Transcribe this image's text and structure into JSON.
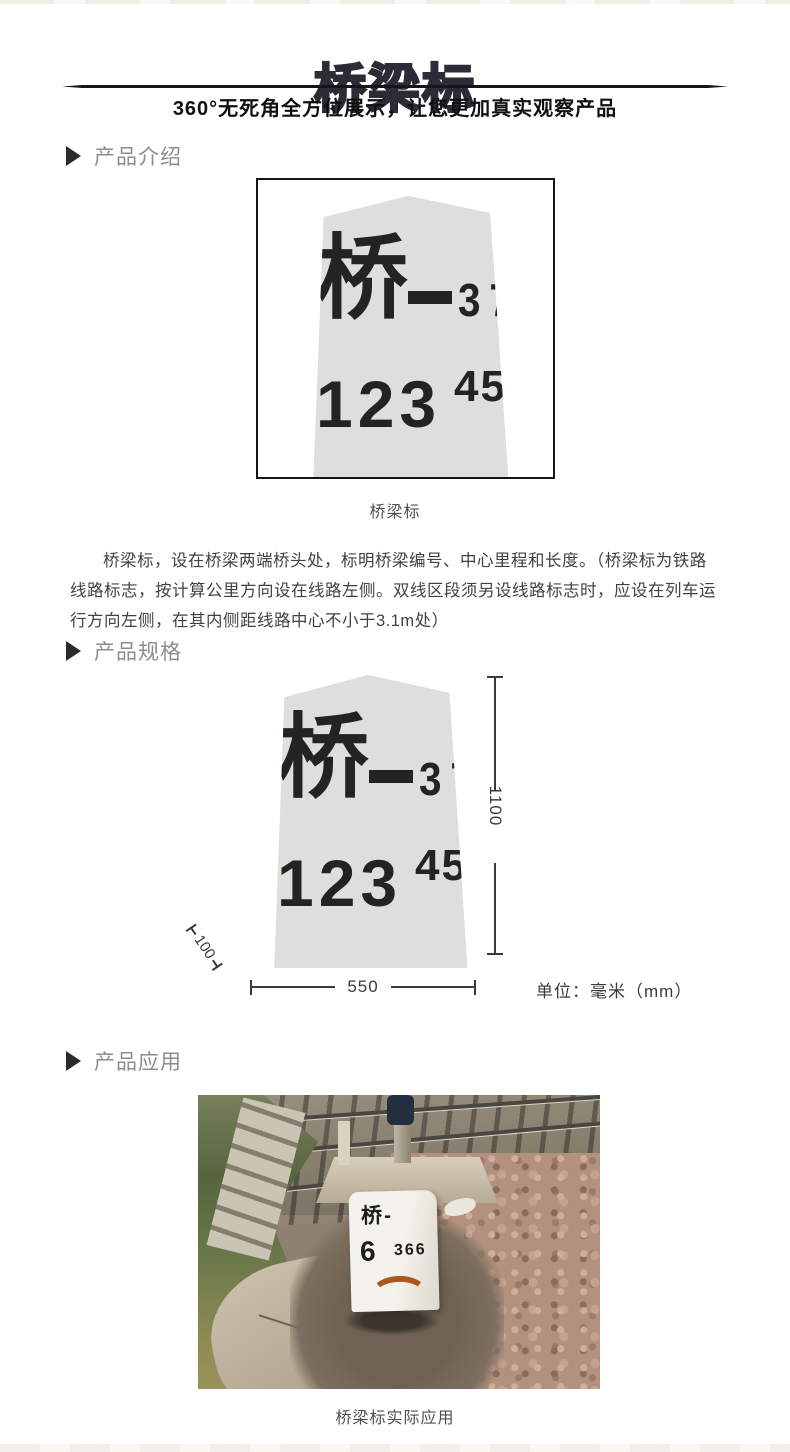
{
  "header": {
    "title": "桥梁标",
    "subtitle": "360°无死角全方位展示，让您更加真实观察产品"
  },
  "sections": {
    "intro_label": "产品介绍",
    "spec_label": "产品规格",
    "app_label": "产品应用"
  },
  "marker_face": {
    "char": "桥",
    "dash": "-",
    "serial": "37",
    "mileage_main": "123",
    "mileage_sup": "456"
  },
  "intro": {
    "caption": "桥梁标",
    "description": "桥梁标，设在桥梁两端桥头处，标明桥梁编号、中心里程和长度。（桥梁标为铁路线路标志，按计算公里方向设在线路左侧。双线区段须另设线路标志时，应设在列车运行方向左侧，在其内侧距线路中心不小于3.1m处）"
  },
  "spec": {
    "height_mm": "1100",
    "width_mm": "550",
    "base_depth_mm": "100",
    "unit": "单位：毫米（mm）"
  },
  "application": {
    "caption": "桥梁标实际应用",
    "photo_marker_line1": "桥-",
    "photo_marker_num": "6",
    "photo_marker_num_small": "366"
  },
  "colors": {
    "title": "#2c2c37",
    "section_label": "#8d8d8d",
    "stone": "#dededc",
    "stone_text": "#23231f",
    "body_text": "#424242",
    "dimension": "#3a3a3a"
  }
}
